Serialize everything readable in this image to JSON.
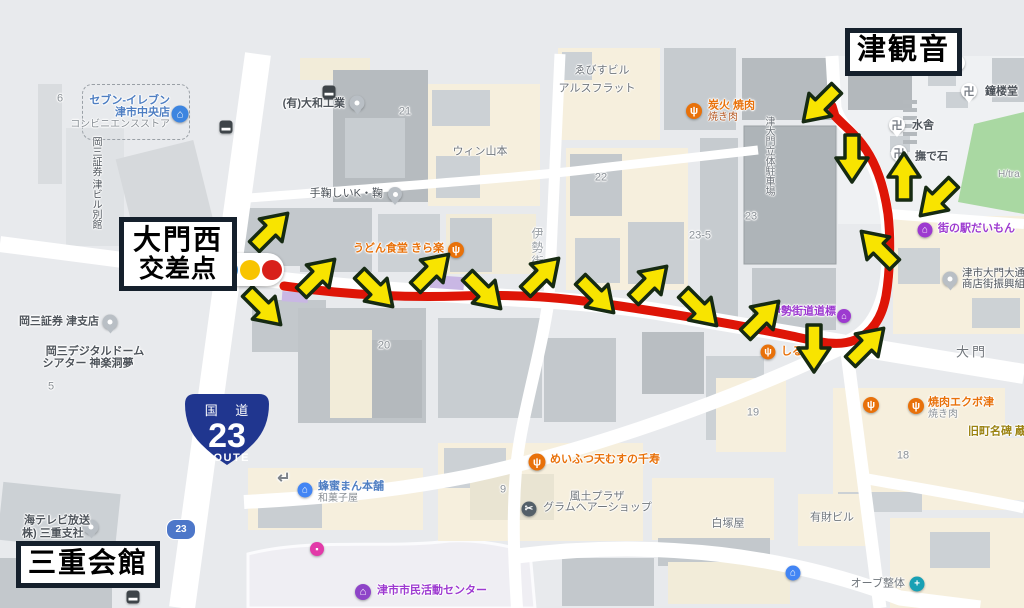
{
  "annotations": {
    "tsu_kannon": "津観音",
    "daimon_nishi_line1": "大門西",
    "daimon_nishi_line2": "交差点",
    "mie_kaikan": "三重会館",
    "route_shield": {
      "top": "国 道",
      "number": "23",
      "bottom": "ROUTE",
      "color": "#20368f"
    },
    "small_shield": "23",
    "traffic_light_colors": [
      "#3d8bd4",
      "#f8c400",
      "#d8201a"
    ],
    "route_color": "#de1507",
    "route_path": "M284,286 C340,294 400,298 460,296 C520,294 560,297 620,306 C680,315 740,325 792,336 C820,342 838,347 855,340 C872,333 882,318 886,296 C890,272 891,240 888,214 C884,186 876,162 862,144 C852,131 842,124 835,116 L832,106",
    "arrow_style": {
      "fill": "#f8e400",
      "stroke": "#162a12"
    },
    "arrows": [
      {
        "x": 270,
        "y": 231,
        "r": -45
      },
      {
        "x": 263,
        "y": 307,
        "r": 45
      },
      {
        "x": 317,
        "y": 277,
        "r": -45
      },
      {
        "x": 375,
        "y": 289,
        "r": 45
      },
      {
        "x": 431,
        "y": 272,
        "r": -45
      },
      {
        "x": 483,
        "y": 291,
        "r": 45
      },
      {
        "x": 541,
        "y": 276,
        "r": -45
      },
      {
        "x": 596,
        "y": 295,
        "r": 45
      },
      {
        "x": 649,
        "y": 284,
        "r": -45
      },
      {
        "x": 699,
        "y": 308,
        "r": 45
      },
      {
        "x": 761,
        "y": 319,
        "r": -45
      },
      {
        "x": 814,
        "y": 347,
        "r": 90
      },
      {
        "x": 866,
        "y": 346,
        "r": -45
      },
      {
        "x": 879,
        "y": 249,
        "r": -135
      },
      {
        "x": 904,
        "y": 178,
        "r": -90
      },
      {
        "x": 938,
        "y": 198,
        "r": 135
      },
      {
        "x": 852,
        "y": 157,
        "r": 90
      },
      {
        "x": 821,
        "y": 104,
        "r": 135
      }
    ]
  },
  "map": {
    "palette": {
      "orange": "#e8710a",
      "blue": "#4e7ec2",
      "purple": "#9d3ad0",
      "grey": "#4e545b",
      "bldg": "#70767c",
      "plot": "#8a9096",
      "road": "#9aa0a5",
      "olive": "#9b8312",
      "district": "#6f747a",
      "sub": "#8a9096",
      "tag": "#b3541e",
      "roadarrow": "#7d838a"
    },
    "pois": [
      {
        "id": "seven-eleven",
        "icons": [
          {
            "k": "convenience-store-icon",
            "x": 180,
            "y": 114,
            "s": 17,
            "bg": "#3d85e0",
            "g": "⌂",
            "shape": "c"
          }
        ],
        "labels": [
          {
            "t": "セブン-イレブン",
            "x": 170,
            "y": 101,
            "col": "blue",
            "align": "r",
            "b": 1
          },
          {
            "t": "津市中央店",
            "x": 170,
            "y": 113,
            "col": "blue",
            "align": "r",
            "b": 1
          },
          {
            "t": "コンビニエンスストア",
            "x": 170,
            "y": 125,
            "col": "sub",
            "align": "r",
            "s": 10
          }
        ]
      },
      {
        "id": "okasan-annex",
        "labels": [
          {
            "t": "岡三証券 津ビル別館",
            "x": 95,
            "y": 183,
            "col": "grey",
            "vert": true,
            "s": 10
          }
        ]
      },
      {
        "id": "okasan-tsu-branch",
        "icons": [
          {
            "k": "place-pin-icon",
            "x": 110,
            "y": 322,
            "s": 15,
            "shape": "pin"
          }
        ],
        "labels": [
          {
            "t": "岡三証券 津支店",
            "x": 99,
            "y": 322,
            "col": "grey",
            "align": "r",
            "b": 1
          }
        ]
      },
      {
        "id": "okasan-dome-theater",
        "labels": [
          {
            "t": "岡三デジタルドーム",
            "x": 95,
            "y": 352,
            "col": "grey",
            "align": "c",
            "b": 1
          },
          {
            "t": "シアター 神楽洞夢",
            "x": 88,
            "y": 364,
            "col": "grey",
            "align": "c",
            "b": 1
          }
        ]
      },
      {
        "id": "yamato-kogyo",
        "icons": [
          {
            "k": "place-pin-icon",
            "x": 357,
            "y": 103,
            "s": 15,
            "shape": "pin"
          }
        ],
        "labels": [
          {
            "t": "(有)大和工業",
            "x": 345,
            "y": 104,
            "col": "grey",
            "align": "r",
            "b": 1
          }
        ]
      },
      {
        "id": "temari-k",
        "icons": [
          {
            "k": "place-pin-icon",
            "x": 395,
            "y": 194,
            "s": 14,
            "shape": "pin"
          }
        ],
        "labels": [
          {
            "t": "手鞠しいK・鞠",
            "x": 383,
            "y": 194,
            "col": "grey",
            "align": "r"
          }
        ]
      },
      {
        "id": "win-yamamoto",
        "labels": [
          {
            "t": "ウィン山本",
            "x": 480,
            "y": 152,
            "col": "bldg",
            "align": "c"
          }
        ]
      },
      {
        "id": "ebisu-building",
        "labels": [
          {
            "t": "ゑびすビル",
            "x": 602,
            "y": 71,
            "col": "bldg",
            "align": "c"
          }
        ]
      },
      {
        "id": "ars-flat",
        "labels": [
          {
            "t": "アルスフラット",
            "x": 597,
            "y": 89,
            "col": "bldg",
            "align": "c"
          }
        ]
      },
      {
        "id": "udon-kiraraku",
        "icons": [
          {
            "k": "restaurant-icon",
            "x": 456,
            "y": 250,
            "s": 16,
            "bg": "#e8710a",
            "g": "ψ",
            "shape": "c"
          }
        ],
        "labels": [
          {
            "t": "うどん食堂 きら楽",
            "x": 444,
            "y": 249,
            "col": "orange",
            "align": "r",
            "b": 1
          }
        ]
      },
      {
        "id": "sumibi-yakiniku",
        "icons": [
          {
            "k": "restaurant-icon",
            "x": 694,
            "y": 111,
            "s": 16,
            "bg": "#e8710a",
            "g": "ψ",
            "shape": "c"
          }
        ],
        "labels": [
          {
            "t": "炭火 焼肉",
            "x": 708,
            "y": 106,
            "col": "orange",
            "align": "l",
            "b": 1
          },
          {
            "t": "焼き肉",
            "x": 708,
            "y": 118,
            "col": "tag",
            "align": "l",
            "s": 10
          }
        ]
      },
      {
        "id": "ise-kaido-street",
        "labels": [
          {
            "t": "伊勢街道",
            "x": 537,
            "y": 255,
            "col": "road",
            "vert": true,
            "s": 12,
            "ls": 2
          }
        ]
      },
      {
        "id": "tsu-daimon-parking",
        "labels": [
          {
            "t": "津大門立体駐車場",
            "x": 768,
            "y": 156,
            "col": "bldg",
            "vert": true,
            "s": 10
          }
        ]
      },
      {
        "id": "shoro-do",
        "icons": [
          {
            "k": "temple-icon",
            "x": 969,
            "y": 91,
            "s": 16,
            "shape": "temple",
            "g": "卍"
          }
        ],
        "labels": [
          {
            "t": "鐘楼堂",
            "x": 985,
            "y": 92,
            "col": "grey",
            "align": "l",
            "b": 1
          }
        ]
      },
      {
        "id": "mizuya",
        "icons": [
          {
            "k": "temple-icon",
            "x": 897,
            "y": 125,
            "s": 16,
            "shape": "temple",
            "g": "卍"
          }
        ],
        "labels": [
          {
            "t": "水舎",
            "x": 912,
            "y": 126,
            "col": "grey",
            "align": "l",
            "b": 1
          }
        ]
      },
      {
        "id": "nade-ishi",
        "icons": [
          {
            "k": "temple-icon",
            "x": 899,
            "y": 153,
            "s": 16,
            "shape": "temple",
            "g": "卍"
          }
        ],
        "labels": [
          {
            "t": "撫で石",
            "x": 915,
            "y": 157,
            "col": "grey",
            "align": "l",
            "b": 1
          }
        ]
      },
      {
        "id": "temple-marker",
        "icons": [
          {
            "k": "temple-icon",
            "x": 957,
            "y": 63,
            "s": 16,
            "shape": "temple",
            "g": "卍"
          }
        ]
      },
      {
        "id": "h-tra",
        "labels": [
          {
            "t": "H/tra",
            "x": 998,
            "y": 175,
            "col": "sub",
            "align": "l",
            "s": 10
          }
        ]
      },
      {
        "id": "machinoeki-daimon",
        "icons": [
          {
            "k": "shopping-icon",
            "x": 925,
            "y": 230,
            "s": 15,
            "bg": "#9d3ad0",
            "g": "⌂",
            "shape": "c"
          }
        ],
        "labels": [
          {
            "t": "街の駅だいもん",
            "x": 938,
            "y": 229,
            "col": "purple",
            "align": "l",
            "b": 1
          }
        ]
      },
      {
        "id": "shotengai-kumiai",
        "icons": [
          {
            "k": "place-pin-icon",
            "x": 950,
            "y": 279,
            "s": 15,
            "shape": "pin"
          }
        ],
        "labels": [
          {
            "t": "津市大門大通り",
            "x": 962,
            "y": 273,
            "col": "grey",
            "align": "l",
            "s": 10.5
          },
          {
            "t": "商店街振興組合",
            "x": 962,
            "y": 284,
            "col": "grey",
            "align": "l",
            "s": 10.5
          }
        ]
      },
      {
        "id": "ise-kaido-dohyo",
        "icons": [
          {
            "k": "landmark-icon",
            "x": 844,
            "y": 316,
            "s": 14,
            "bg": "#9d3ad0",
            "g": "⌂",
            "shape": "c"
          }
        ],
        "labels": [
          {
            "t": "伊勢街道道標",
            "x": 836,
            "y": 312,
            "col": "purple",
            "align": "r",
            "b": 1
          }
        ]
      },
      {
        "id": "shirube",
        "icons": [
          {
            "k": "restaurant-icon",
            "x": 768,
            "y": 352,
            "s": 15,
            "bg": "#e8710a",
            "g": "ψ",
            "shape": "c"
          }
        ],
        "labels": [
          {
            "t": "しるべ",
            "x": 781,
            "y": 352,
            "col": "orange",
            "align": "l",
            "b": 1
          }
        ]
      },
      {
        "id": "daimon-district",
        "labels": [
          {
            "t": "大門",
            "x": 972,
            "y": 352,
            "col": "district",
            "align": "c",
            "s": 13,
            "ls": 3
          }
        ]
      },
      {
        "id": "yakiniku-ekubo",
        "icons": [
          {
            "k": "restaurant-icon",
            "x": 916,
            "y": 406,
            "s": 16,
            "bg": "#e8710a",
            "g": "ψ",
            "shape": "c"
          }
        ],
        "labels": [
          {
            "t": "焼肉エクボ津",
            "x": 928,
            "y": 403,
            "col": "orange",
            "align": "l",
            "b": 1
          },
          {
            "t": "焼き肉",
            "x": 928,
            "y": 415,
            "col": "sub",
            "align": "l",
            "s": 10
          }
        ]
      },
      {
        "id": "restaurant-unnamed",
        "icons": [
          {
            "k": "restaurant-icon",
            "x": 871,
            "y": 405,
            "s": 16,
            "bg": "#e8710a",
            "g": "ψ",
            "shape": "c"
          }
        ]
      },
      {
        "id": "kyuchomei-hi",
        "labels": [
          {
            "t": "旧町名碑 蔵",
            "x": 968,
            "y": 432,
            "col": "olive",
            "align": "l",
            "b": 1
          }
        ]
      },
      {
        "id": "tenmusu-senju",
        "icons": [
          {
            "k": "restaurant-icon",
            "x": 537,
            "y": 462,
            "s": 17,
            "bg": "#e8710a",
            "g": "ψ",
            "shape": "c"
          }
        ],
        "labels": [
          {
            "t": "めいふつ天むすの千寿",
            "x": 550,
            "y": 460,
            "col": "orange",
            "align": "l",
            "b": 1
          }
        ]
      },
      {
        "id": "fudo-plaza",
        "labels": [
          {
            "t": "風土プラザ",
            "x": 597,
            "y": 497,
            "col": "bldg",
            "align": "c"
          }
        ]
      },
      {
        "id": "gram-hair-shop",
        "icons": [
          {
            "k": "hair-salon-icon",
            "x": 529,
            "y": 509,
            "s": 15,
            "bg": "#546069",
            "g": "✂",
            "shape": "c"
          }
        ],
        "labels": [
          {
            "t": "グラムヘアーショップ",
            "x": 543,
            "y": 508,
            "col": "bldg",
            "align": "l"
          }
        ]
      },
      {
        "id": "shiratsuka-ya",
        "labels": [
          {
            "t": "白塚屋",
            "x": 728,
            "y": 524,
            "col": "bldg",
            "align": "c"
          }
        ]
      },
      {
        "id": "yuzai-building",
        "labels": [
          {
            "t": "有財ビル",
            "x": 832,
            "y": 518,
            "col": "bldg",
            "align": "c"
          }
        ]
      },
      {
        "id": "lodging",
        "icons": [
          {
            "k": "lodging-icon",
            "x": 793,
            "y": 573,
            "s": 15,
            "bg": "#4285f4",
            "g": "⌂",
            "shape": "c"
          }
        ]
      },
      {
        "id": "orb-seitai",
        "icons": [
          {
            "k": "massage-icon",
            "x": 917,
            "y": 584,
            "s": 15,
            "bg": "#18a0b4",
            "g": "+",
            "shape": "c"
          }
        ],
        "labels": [
          {
            "t": "オーブ整体",
            "x": 905,
            "y": 584,
            "col": "bldg",
            "align": "r"
          }
        ]
      },
      {
        "id": "shimin-katsudo-center",
        "icons": [
          {
            "k": "community-center-icon",
            "x": 363,
            "y": 592,
            "s": 16,
            "bg": "#8e44c8",
            "g": "⌂",
            "shape": "c"
          }
        ],
        "labels": [
          {
            "t": "津市市民活動センター",
            "x": 377,
            "y": 591,
            "col": "purple",
            "align": "l",
            "b": 1
          }
        ]
      },
      {
        "id": "tokai-tv",
        "icons": [
          {
            "k": "place-pin-icon",
            "x": 91,
            "y": 527,
            "s": 15,
            "shape": "pin"
          }
        ],
        "labels": [
          {
            "t": "海テレビ放送",
            "x": 24,
            "y": 521,
            "col": "grey",
            "align": "l",
            "b": 1
          },
          {
            "t": "株) 三重支社",
            "x": 22,
            "y": 534,
            "col": "grey",
            "align": "l",
            "b": 1
          }
        ]
      },
      {
        "id": "hachimitsu-man",
        "icons": [
          {
            "k": "shop-icon",
            "x": 305,
            "y": 490,
            "s": 15,
            "bg": "#4285f4",
            "g": "⌂",
            "shape": "c"
          }
        ],
        "labels": [
          {
            "t": "蜂蜜まん本舗",
            "x": 318,
            "y": 487,
            "col": "blue",
            "align": "l",
            "b": 1
          },
          {
            "t": "和菓子屋",
            "x": 318,
            "y": 499,
            "col": "sub",
            "align": "l",
            "s": 10
          }
        ]
      },
      {
        "id": "turn-arrow",
        "labels": [
          {
            "t": "↵",
            "x": 284,
            "y": 479,
            "col": "roadarrow",
            "align": "c",
            "s": 16,
            "b": 1
          }
        ]
      },
      {
        "id": "bus-stop-1",
        "icons": [
          {
            "k": "bus-stop-icon",
            "x": 329,
            "y": 92,
            "s": 13,
            "bg": "#3e4449",
            "g": "▬",
            "shape": "sq"
          }
        ]
      },
      {
        "id": "bus-stop-2",
        "icons": [
          {
            "k": "bus-stop-icon",
            "x": 226,
            "y": 127,
            "s": 13,
            "bg": "#3e4449",
            "g": "▬",
            "shape": "sq"
          }
        ]
      },
      {
        "id": "bus-stop-3",
        "icons": [
          {
            "k": "bus-stop-icon",
            "x": 133,
            "y": 597,
            "s": 13,
            "bg": "#3e4449",
            "g": "▬",
            "shape": "sq"
          }
        ]
      },
      {
        "id": "cinema",
        "icons": [
          {
            "k": "cinema-icon",
            "x": 317,
            "y": 549,
            "s": 14,
            "bg": "#e23aa8",
            "g": "▪",
            "shape": "c"
          }
        ]
      }
    ],
    "plot_numbers": [
      [
        "6",
        60,
        99
      ],
      [
        "21",
        405,
        112
      ],
      [
        "22",
        601,
        178
      ],
      [
        "23",
        751,
        217
      ],
      [
        "23-5",
        700,
        236
      ],
      [
        "20",
        384,
        346
      ],
      [
        "5",
        51,
        387
      ],
      [
        "19",
        753,
        413
      ],
      [
        "18",
        903,
        456
      ],
      [
        "9",
        503,
        490
      ]
    ]
  }
}
